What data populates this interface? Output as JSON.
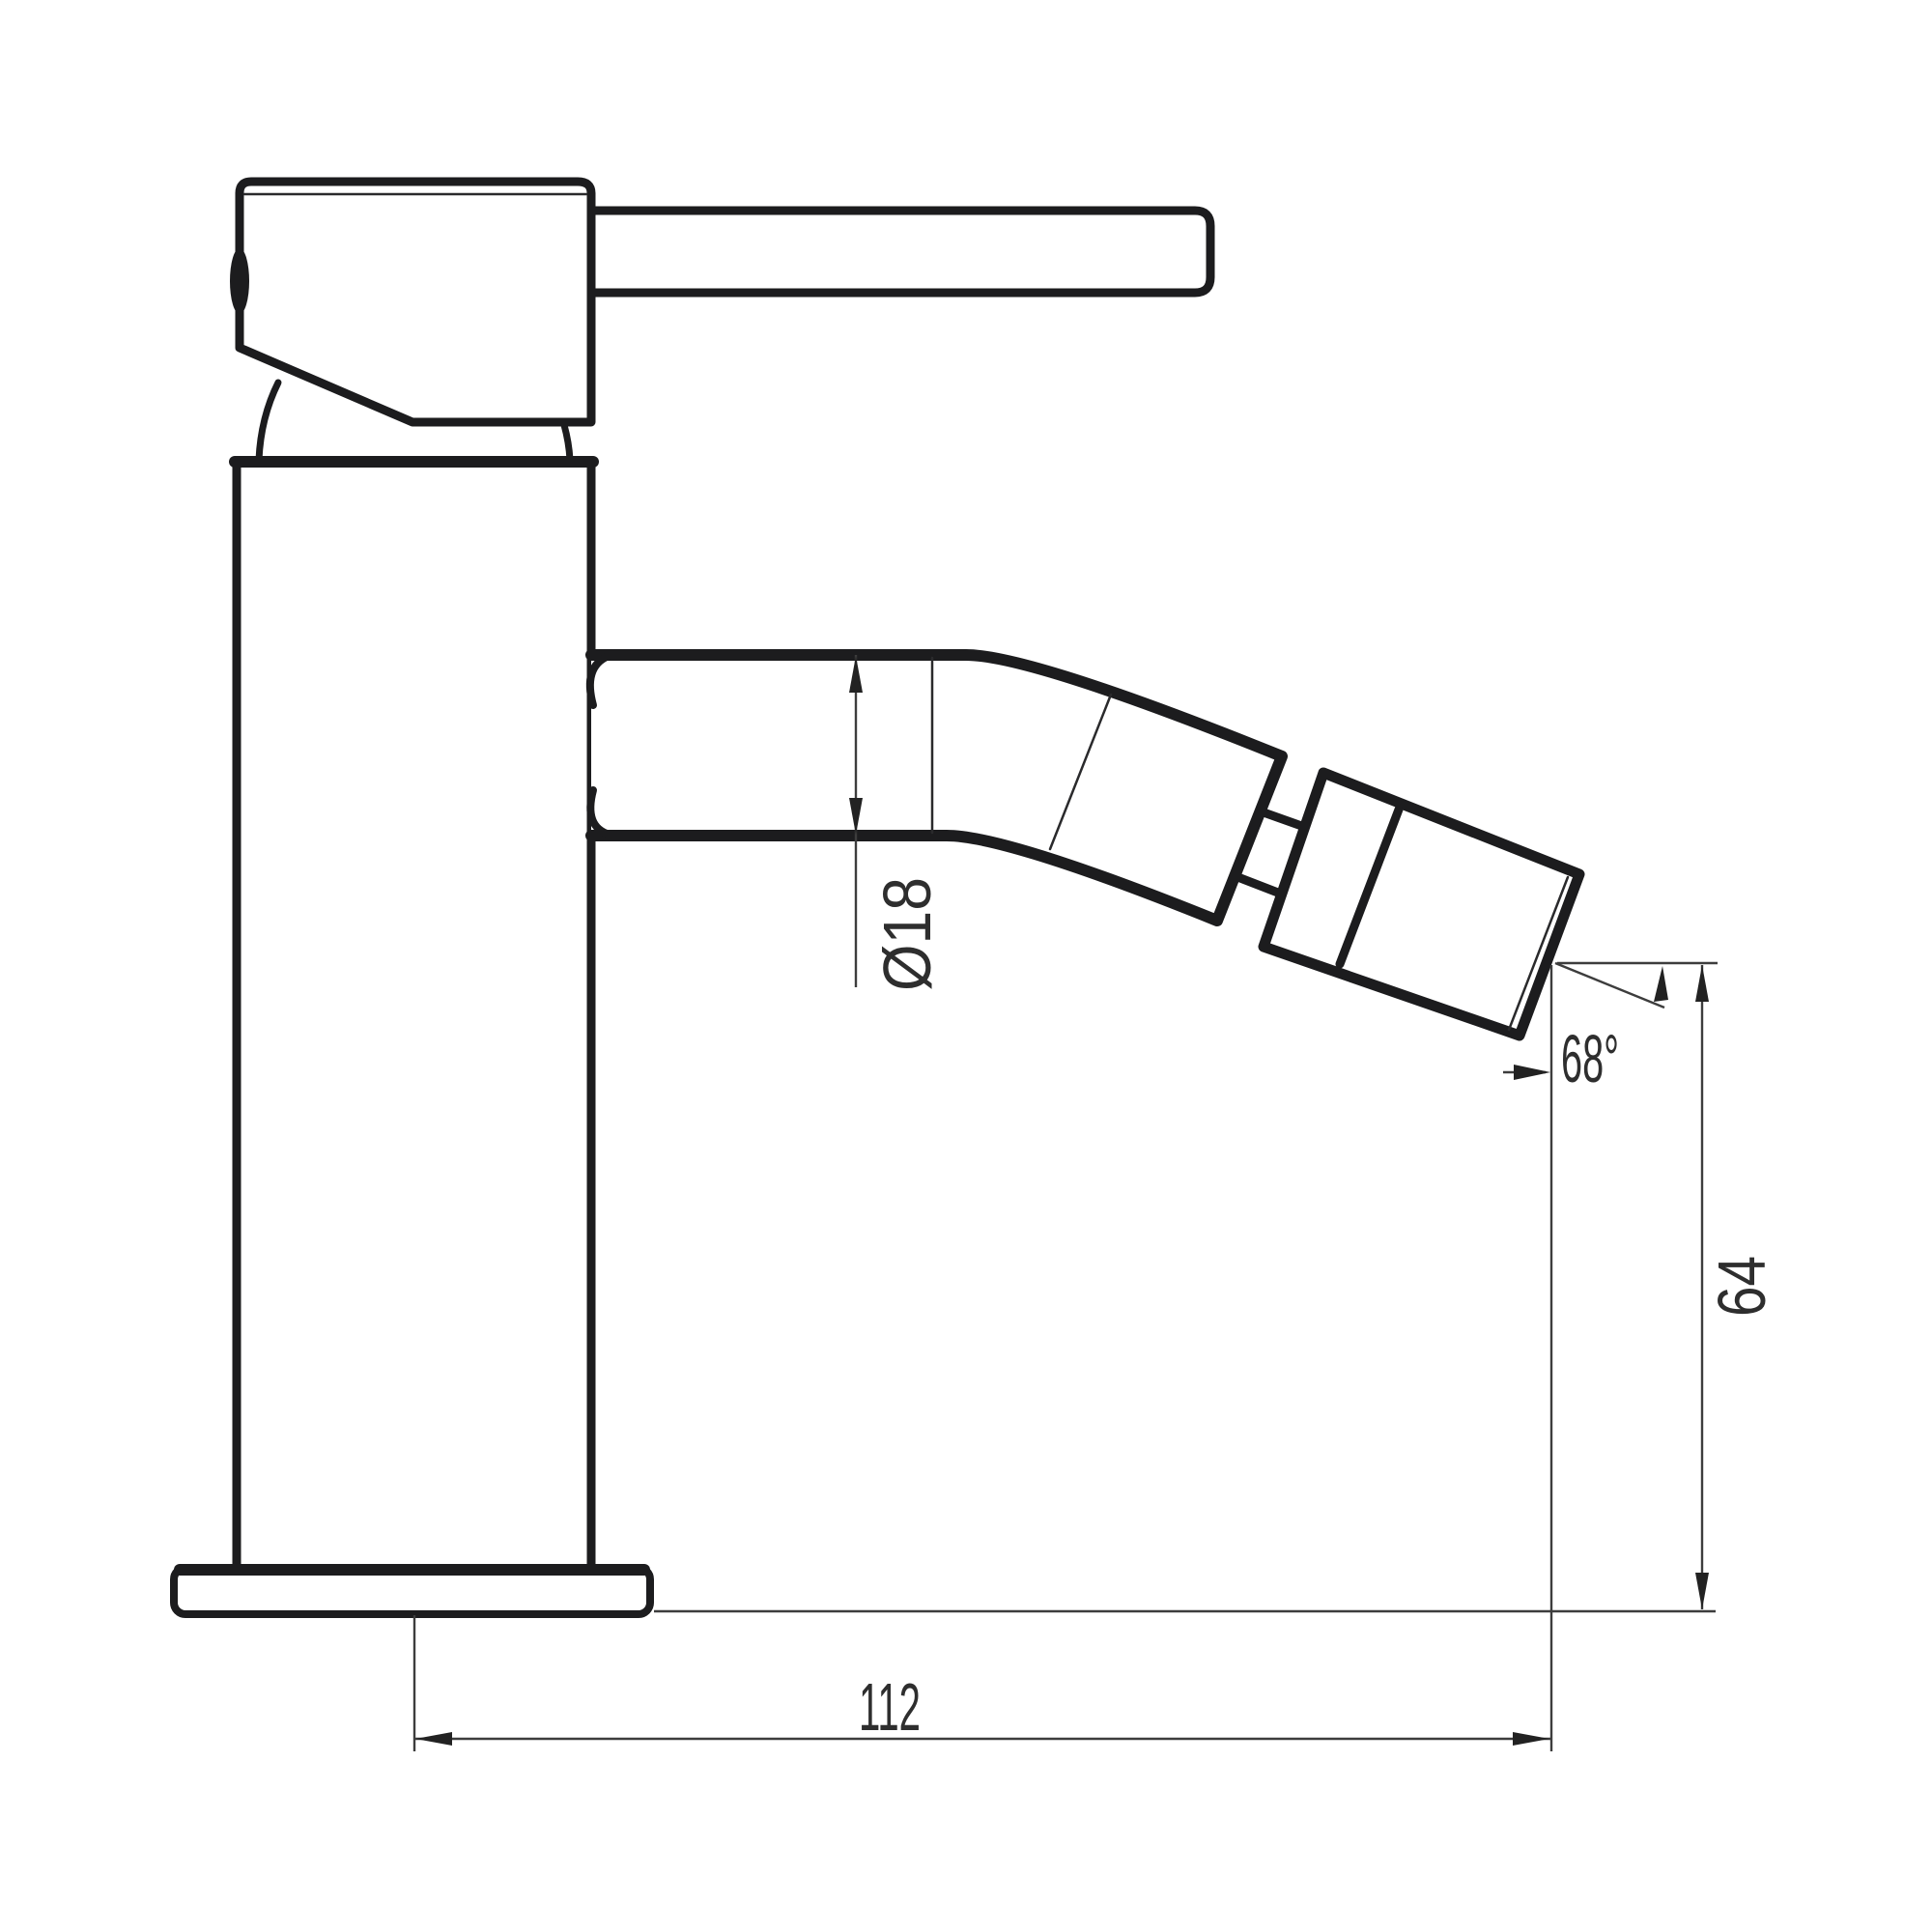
{
  "drawing": {
    "background": "#ffffff",
    "line_color": "#1c1c1e",
    "dim_line_color": "#3d3d3d",
    "dim_text_color": "#2e2e2e",
    "dimensions": {
      "spout_diameter": "Ø18",
      "spray_angle": "68°",
      "outlet_height": "64",
      "spout_reach": "112"
    }
  }
}
